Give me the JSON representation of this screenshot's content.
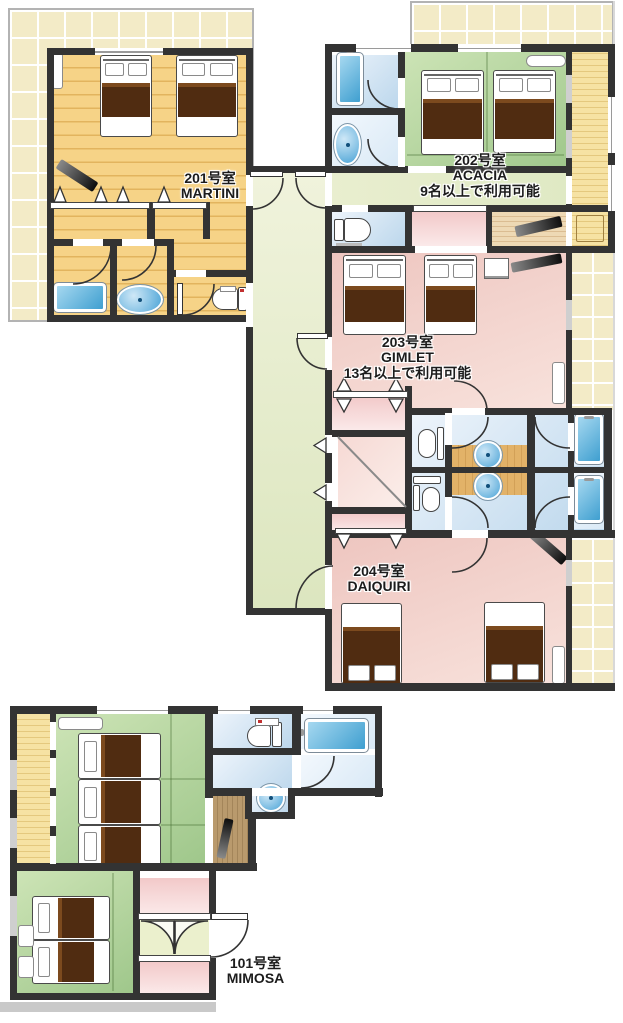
{
  "rooms": [
    {
      "number": "201号室",
      "name": "MARTINI"
    },
    {
      "number": "202号室",
      "name": "ACACIA",
      "note": "9名以上で利用可能"
    },
    {
      "number": "203号室",
      "name": "GIMLET",
      "note": "13名以上で利用可能"
    },
    {
      "number": "204号室",
      "name": "DAIQUIRI"
    },
    {
      "number": "101号室",
      "name": "MIMOSA"
    }
  ],
  "colors": {
    "wall": "#333333",
    "terrace": "#f3ebc7",
    "terrace_line": "#ffffff",
    "wood_floor": "#f6d387",
    "wood_floor_line": "#e2b45e",
    "tatami_light": "#cde4b6",
    "tatami_dark": "#9fc78b",
    "pink_light": "#f8e2dc",
    "pink_dark": "#eec6c0",
    "closet_pink": "#f2c9c9",
    "bath_dark": "#bcd7ec",
    "corridor_light": "#f0f3dc",
    "corridor_dark": "#dce6bf",
    "engawa": "#f6e2a3",
    "engawa_line": "#e4c87e",
    "counter": "#e2b268",
    "blanket": "#502c11",
    "blanket_fold": "#7c4a1e",
    "label_text": "#1c1c1c"
  }
}
